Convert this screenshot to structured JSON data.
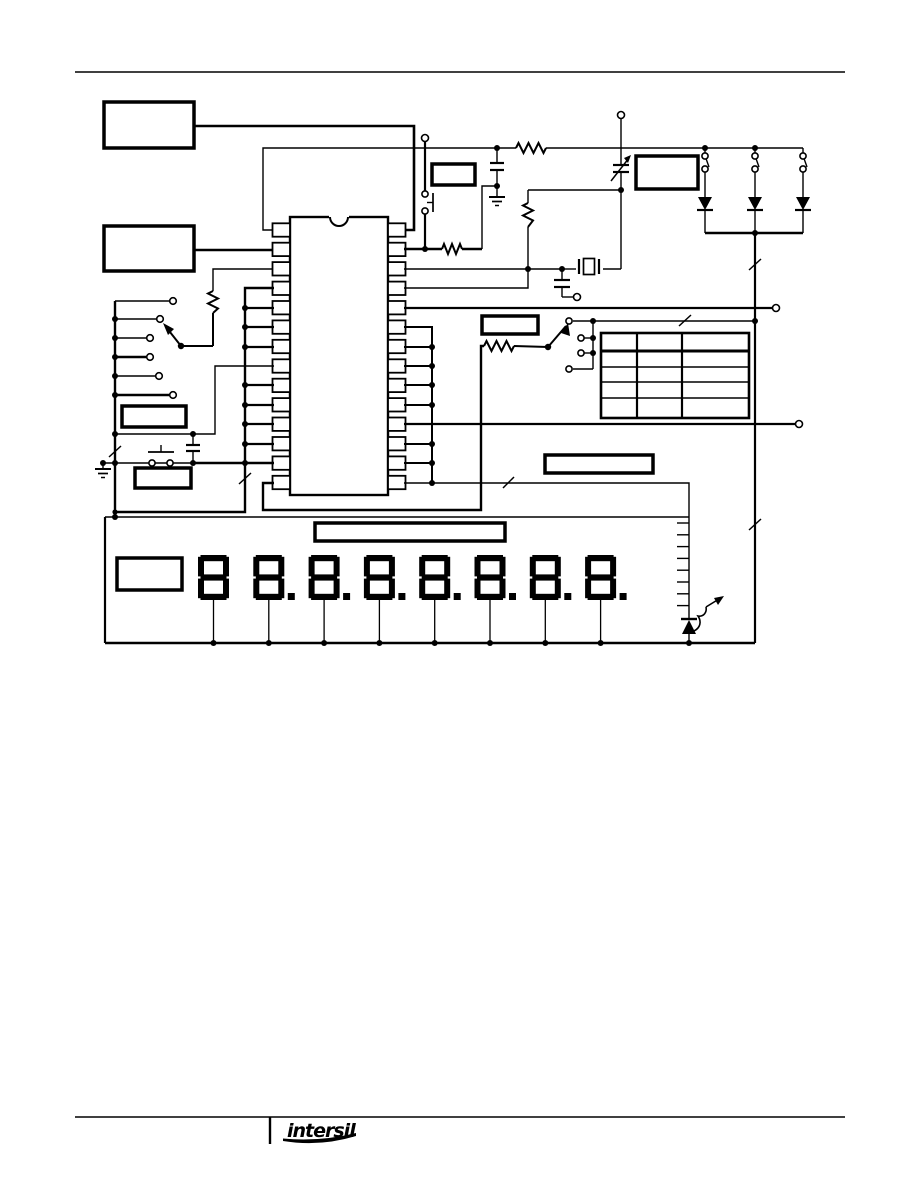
{
  "document": {
    "colors": {
      "ink": "#000000",
      "paper": "#ffffff"
    },
    "footer": {
      "logo_text": "intersil"
    }
  },
  "schematic": {
    "ic": {
      "pins_per_side": 14
    },
    "display": {
      "digit_count": 8,
      "digits": [
        "8",
        "8.",
        "8.",
        "8.",
        "8.",
        "8.",
        "8.",
        "8."
      ]
    },
    "segment_bus": {
      "tick_count": 8
    },
    "truth_table": {
      "rows": 5,
      "columns": 3
    }
  }
}
